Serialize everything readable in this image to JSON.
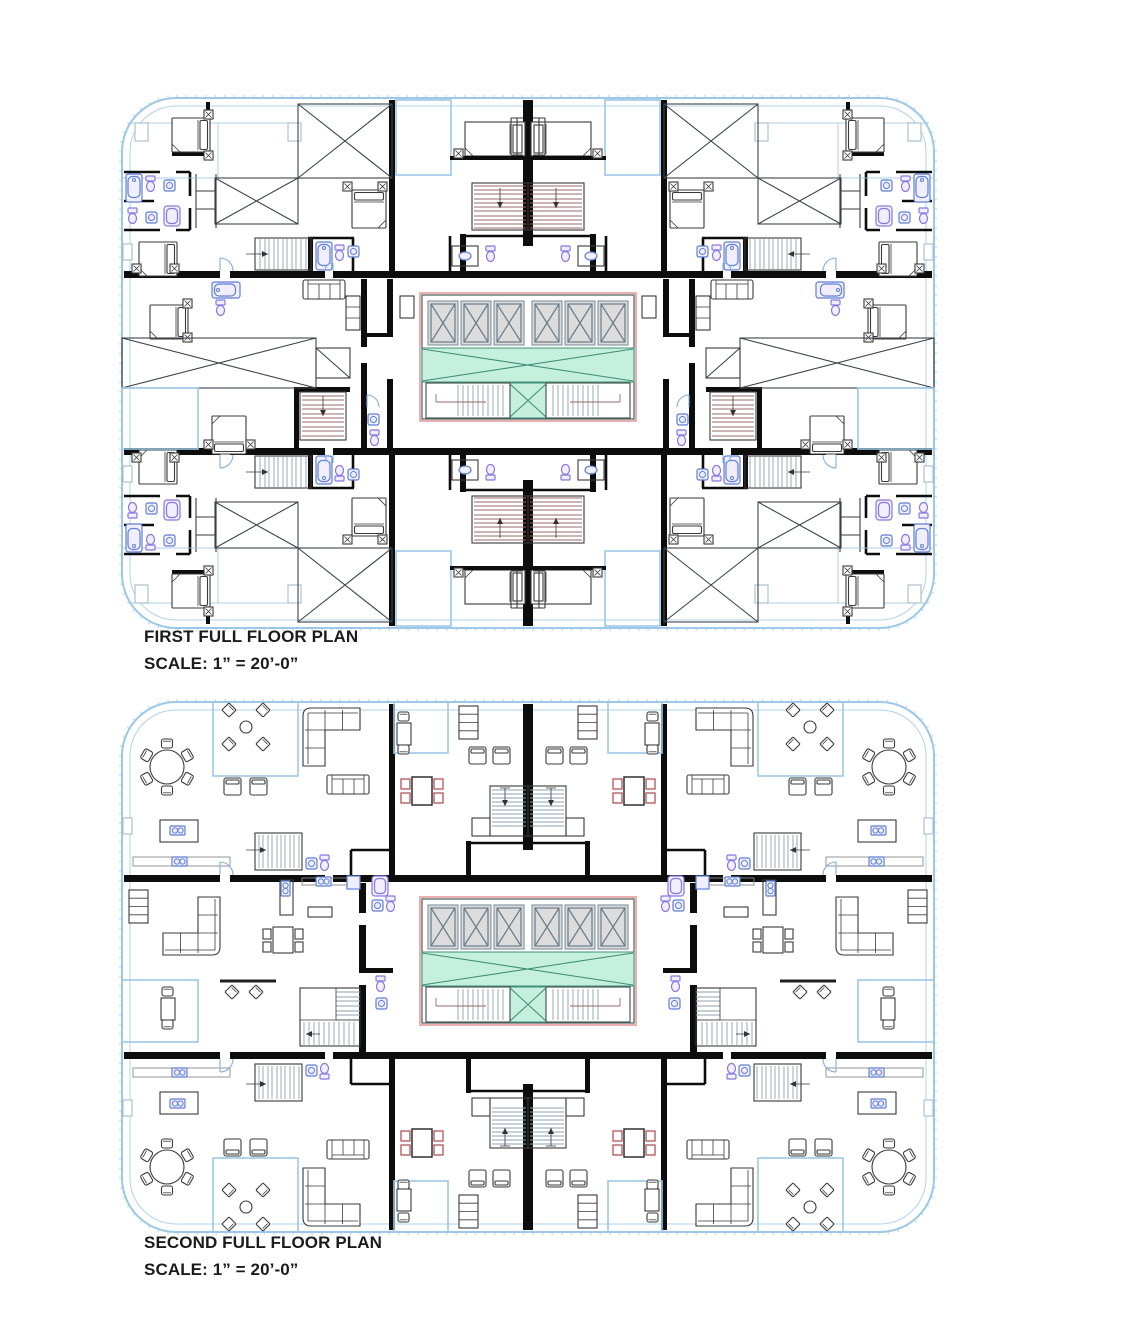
{
  "page": {
    "background": "#ffffff"
  },
  "plans": [
    {
      "title": "FIRST FULL FLOOR PLAN",
      "scale_label": "SCALE: 1” = 20’-0”"
    },
    {
      "title": "SECOND FULL FLOOR PLAN",
      "scale_label": "SCALE: 1” = 20’-0”"
    }
  ],
  "core": {
    "elevator_count": 6,
    "stairwell_count": 2
  },
  "colors": {
    "wall": "#0d0d0d",
    "thin": "#3a3a3a",
    "border_blue": "#9cc7e6",
    "tick_blue": "#bfe3f2",
    "fixture_blue": "#5f7fd4",
    "fixture_violet": "#8678e0",
    "fixture_fill": "#f1efff",
    "green_fill": "#c6f0de",
    "green_line": "#3f8f79",
    "elevator_fill": "#dcdcdc",
    "elevator_line": "#7d8f9b",
    "x_line": "#6a7b88",
    "stair_tread": "#9a6a6a",
    "chair_red": "#b05555",
    "core_outline": "#e8a8a8",
    "text": "#1b1b1b"
  }
}
